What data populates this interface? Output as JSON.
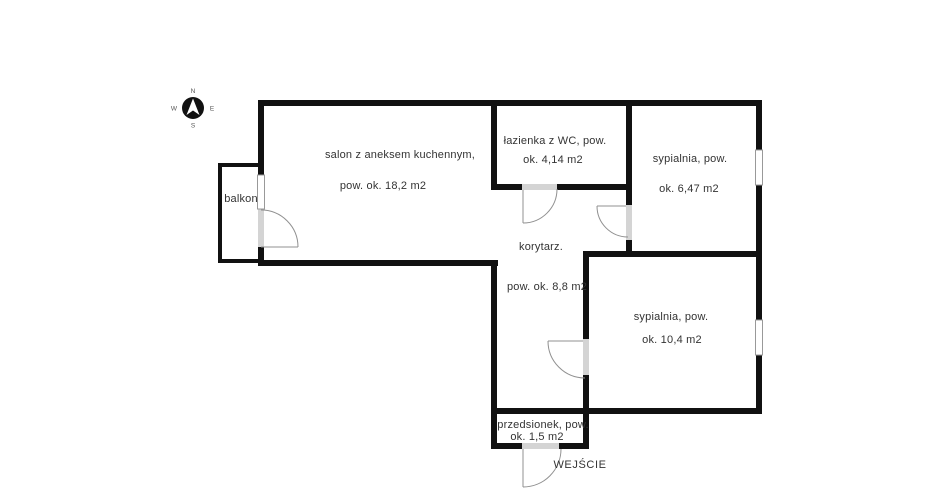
{
  "compass": {
    "n": "N",
    "e": "E",
    "s": "S",
    "w": "W"
  },
  "rooms": {
    "balkon": {
      "name": "balkon"
    },
    "salon": {
      "name": "salon z aneksem kuchennym,",
      "area": "pow. ok. 18,2 m2"
    },
    "lazienka": {
      "name": "łazienka z WC, pow.",
      "area": "ok. 4,14 m2"
    },
    "sypialnia1": {
      "name": "sypialnia, pow.",
      "area": "ok. 6,47 m2"
    },
    "korytarz": {
      "name": "korytarz.",
      "area": "pow. ok. 8,8 m2"
    },
    "sypialnia2": {
      "name": "sypialnia, pow.",
      "area": "ok. 10,4 m2"
    },
    "przedsionek": {
      "name": "przedsionek, pow.",
      "area": "ok. 1,5 m2"
    }
  },
  "entrance_label": "WEJŚCIE",
  "colors": {
    "wall": "#111111",
    "door_opening": "#d4d4d4",
    "window_frame": "#999999",
    "door_swing": "#909090",
    "text": "#333333",
    "background": "#ffffff"
  }
}
